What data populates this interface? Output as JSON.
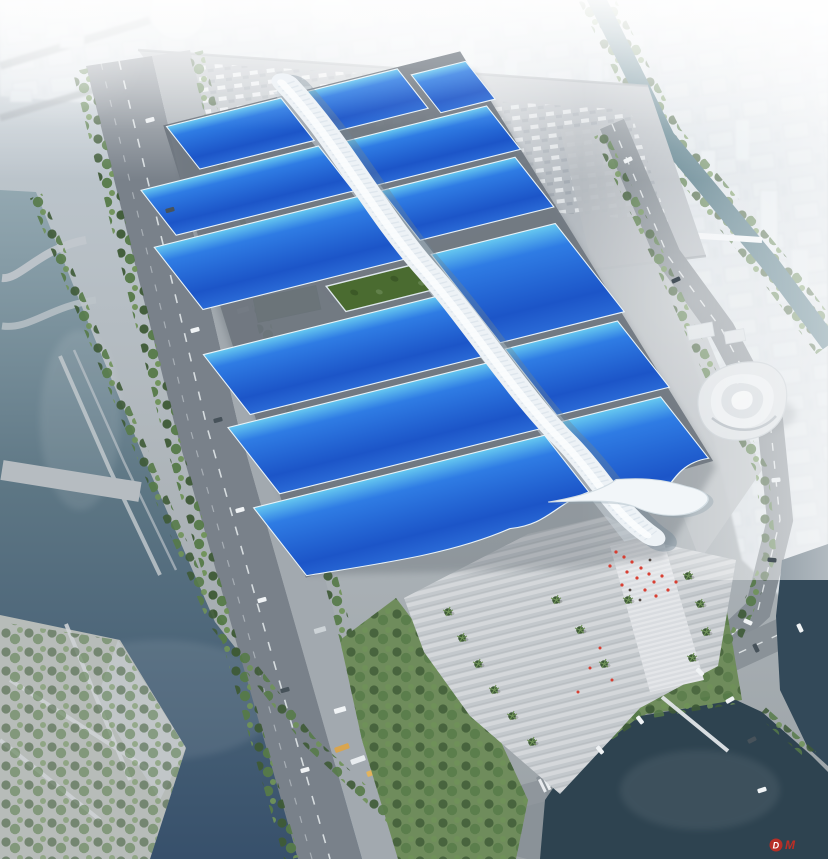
{
  "meta": {
    "title": "Exhibition and Convention Center - Aerial Rendering",
    "description": "Bird's-eye architectural rendering of a riverside exhibition and convention center: paired rows of blue exhibition-hall roofs crossed by a purple ribbon, a white central spine gallery, a south entrance plaza with palm trees and red-clad visitors, surrounded by boulevards, canals, parking lots and a hazy white city skyline.",
    "view": "aerial-perspective"
  },
  "watermark": {
    "letter_d": "D",
    "letter_m": "M"
  },
  "palette": {
    "sky_top": "#c3cdd5",
    "ground": "#aab1b6",
    "city_base": "#dde4e9",
    "city_block": "#e2e8ec",
    "pavement_light": "#c3c8cc",
    "pavement_mid": "#b4bac0",
    "lane_pale": "#a2a9af",
    "road_dark": "#79818a",
    "road_mid": "#868e95",
    "roof_cyan": "#66c8f0",
    "roof_blue": "#2f7ce4",
    "roof_deep": "#1c55c8",
    "roof_navy": "#14308f",
    "ribbon_magenta": "#c43ae6",
    "ribbon_violet": "#8d3bd8",
    "ribbon_dark": "#6d2fc4",
    "spine_white": "#edf2f6",
    "spine_shadow": "#6f8492",
    "canopy_white": "#f2f6f9",
    "green_roof": "#4a6b30",
    "warehouse_green": "#5d7547",
    "tree_green": "#567a48",
    "tree_dark": "#3e5a36",
    "tree_light": "#6f9258",
    "lawn": "#6f8c5c",
    "water_top": "#93a8b1",
    "water_mid": "#5d7684",
    "water_deep": "#37506b",
    "pond": "#2e4350",
    "canal": "#48707e",
    "people_red": "#d8372a",
    "watermark_red": "#cf2b20"
  }
}
